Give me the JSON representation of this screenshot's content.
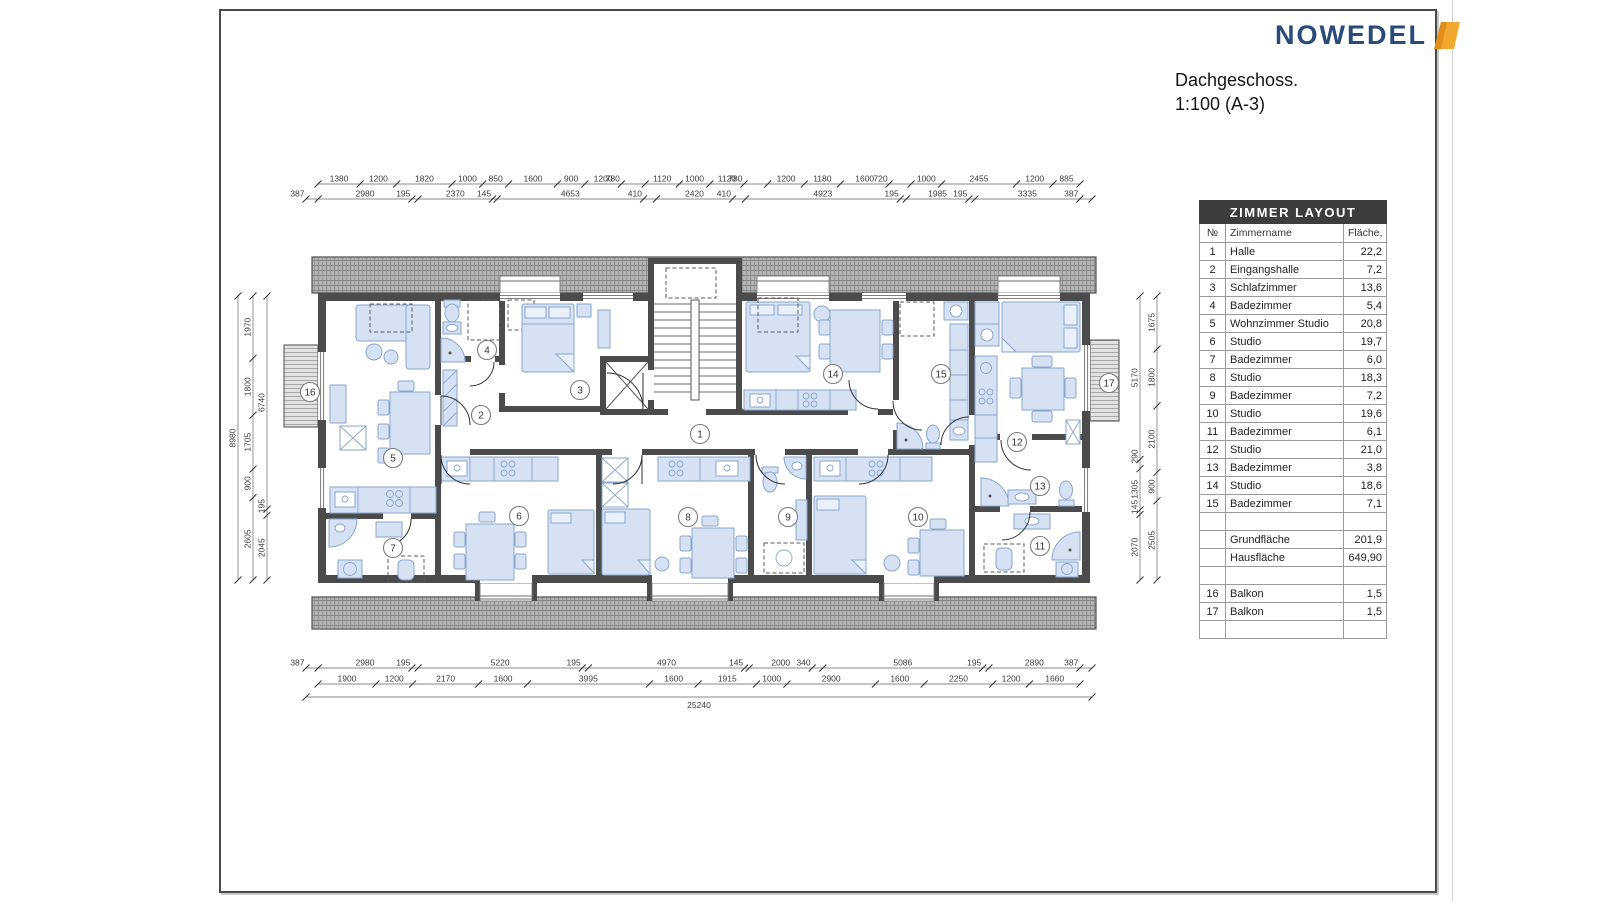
{
  "logo": {
    "text": "NOWEDEL",
    "accent_color": "#F2A72E",
    "text_color": "#2A4A7B"
  },
  "title": {
    "line1": "Dachgeschoss.",
    "line2": "1:100 (A-3)"
  },
  "table": {
    "title": "ZIMMER LAYOUT",
    "columns": [
      "№",
      "Zimmername",
      "Fläche, m2"
    ],
    "rows": [
      {
        "no": "1",
        "name": "Halle",
        "area": "22,2"
      },
      {
        "no": "2",
        "name": "Eingangshalle",
        "area": "7,2"
      },
      {
        "no": "3",
        "name": "Schlafzimmer",
        "area": "13,6"
      },
      {
        "no": "4",
        "name": "Badezimmer",
        "area": "5,4"
      },
      {
        "no": "5",
        "name": "Wohnzimmer Studio",
        "area": "20,8"
      },
      {
        "no": "6",
        "name": "Studio",
        "area": "19,7"
      },
      {
        "no": "7",
        "name": "Badezimmer",
        "area": "6,0"
      },
      {
        "no": "8",
        "name": "Studio",
        "area": "18,3"
      },
      {
        "no": "9",
        "name": "Badezimmer",
        "area": "7,2"
      },
      {
        "no": "10",
        "name": "Studio",
        "area": "19,6"
      },
      {
        "no": "11",
        "name": "Badezimmer",
        "area": "6,1"
      },
      {
        "no": "12",
        "name": "Studio",
        "area": "21,0"
      },
      {
        "no": "13",
        "name": "Badezimmer",
        "area": "3,8"
      },
      {
        "no": "14",
        "name": "Studio",
        "area": "18,6"
      },
      {
        "no": "15",
        "name": "Badezimmer",
        "area": "7,1"
      },
      {
        "no": "",
        "name": "",
        "area": ""
      },
      {
        "no": "",
        "name": "Grundfläche",
        "area": "201,9"
      },
      {
        "no": "",
        "name": "Hausfläche",
        "area": "649,90"
      },
      {
        "no": "",
        "name": "",
        "area": ""
      },
      {
        "no": "16",
        "name": "Balkon",
        "area": "1,5"
      },
      {
        "no": "17",
        "name": "Balkon",
        "area": "1,5"
      },
      {
        "no": "",
        "name": "",
        "area": ""
      }
    ]
  },
  "plan": {
    "rooms": [
      "1",
      "2",
      "3",
      "4",
      "5",
      "6",
      "7",
      "8",
      "9",
      "10",
      "11",
      "12",
      "13",
      "14",
      "15",
      "16",
      "17"
    ],
    "dimensions": {
      "top_row1": [
        "1380",
        "1200",
        "1820",
        "1000",
        "850",
        "1600",
        "900",
        "1200",
        "780",
        "1120",
        "1000",
        "1120",
        "780",
        "1200",
        "1180",
        "1600",
        "720",
        "1000",
        "2455",
        "1200",
        "885"
      ],
      "top_row2": [
        "387",
        "2980",
        "195",
        "2370",
        "145",
        "4653",
        "410",
        "2420",
        "410",
        "4923",
        "195",
        "1985",
        "195",
        "3335",
        "387"
      ],
      "bottom_row1": [
        "387",
        "2980",
        "195",
        "5220",
        "195",
        "4970",
        "145",
        "2000",
        "340",
        "5086",
        "195",
        "2890",
        "387"
      ],
      "bottom_row2": [
        "1900",
        "1200",
        "2170",
        "1600",
        "3995",
        "1600",
        "1915",
        "1000",
        "2900",
        "1600",
        "2250",
        "1200",
        "1660"
      ],
      "bottom_total": "25240",
      "left_outer": [
        "8980"
      ],
      "left_mid": [
        "1970",
        "1800",
        "1705",
        "900",
        "2605"
      ],
      "left_inner": [
        "6740",
        "195",
        "2045"
      ],
      "right_inner": [
        "5170",
        "290",
        "1305",
        "145",
        "2070"
      ],
      "right_outer": [
        "1675",
        "1800",
        "2100",
        "900",
        "2505"
      ]
    }
  },
  "colors": {
    "wall": "#4B4B4B",
    "furniture": "#D6E2F3",
    "furniture_stroke": "#8AA6CD",
    "table_header_bg": "#3D3D3D"
  }
}
